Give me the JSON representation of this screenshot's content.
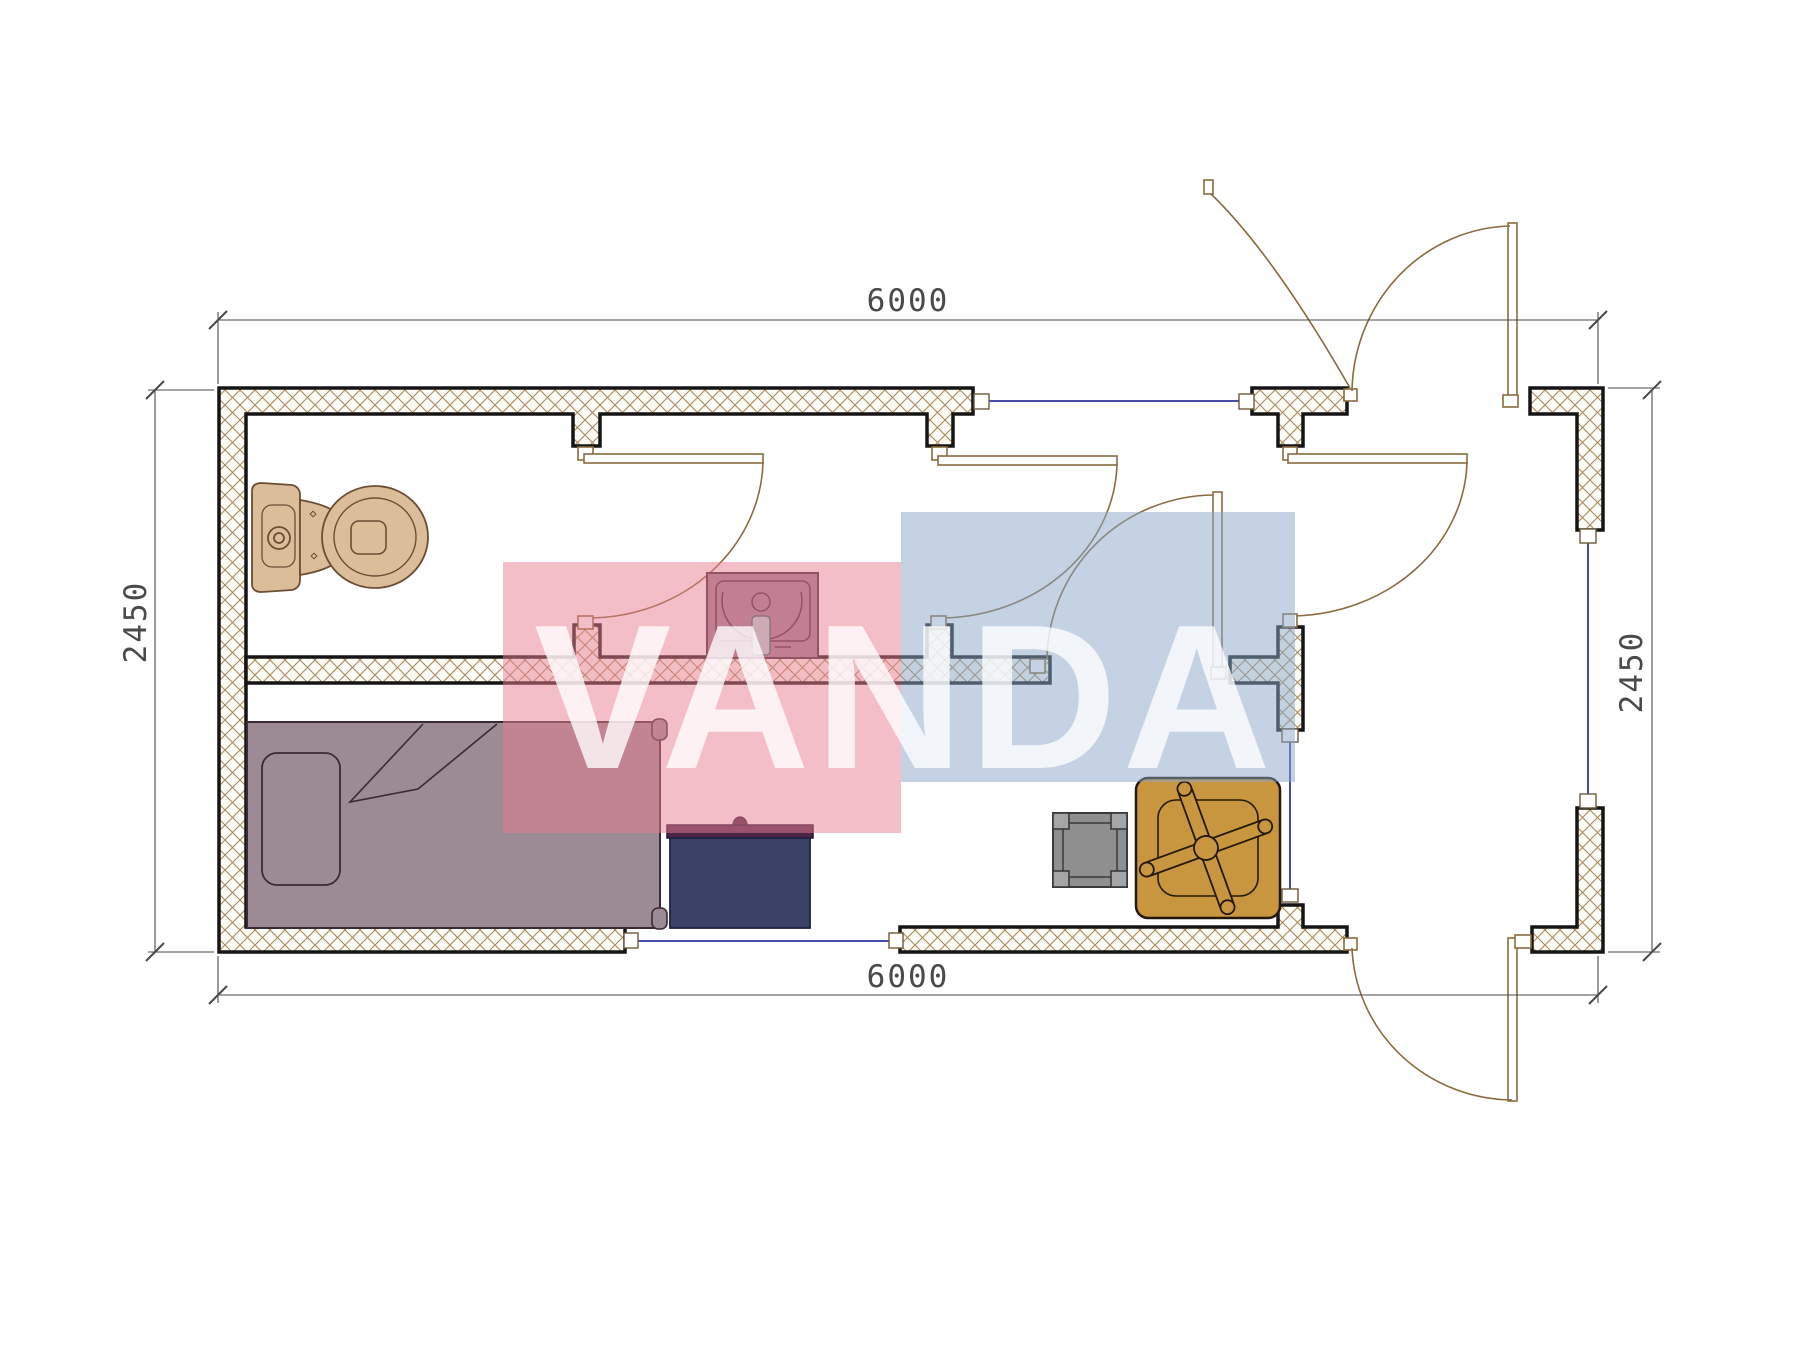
{
  "drawing": {
    "type": "floor-plan-top-view",
    "dimensions": {
      "width_top": "6000",
      "width_bottom": "6000",
      "height_left": "2450",
      "height_right": "2450"
    },
    "watermark": {
      "text": "VANDA",
      "pink_block_color": "#e87d92",
      "blue_block_color": "#8aa6c8",
      "letter_color": "#ffffff"
    },
    "colors": {
      "wall_outline": "#151515",
      "hatch_line": "#a98a5c",
      "door_line": "#8a6b3f",
      "window_line": "#2b35a0",
      "dimension_line": "#4a4a4a",
      "toilet": "#dcbd9a",
      "toilet_outline": "#6b4e33",
      "sink": "#9a8090",
      "sink_outline": "#3f2936",
      "faucet_teal": "#b5d6d8",
      "bed": "#9c8b95",
      "bed_outline": "#3a2a35",
      "desk": "#3b4167",
      "desk_band": "#4b2447",
      "stool": "#8f8f8f",
      "stool_post": "#a5a5a5",
      "chair": "#c8963e",
      "chair_outline": "#23180a"
    },
    "furniture_icons": [
      "toilet-icon",
      "washbasin-icon",
      "single-bed-icon",
      "desk-icon",
      "stool-icon",
      "cross-base-chair-icon"
    ],
    "openings": {
      "door_count": 6,
      "window_count": 4
    }
  }
}
